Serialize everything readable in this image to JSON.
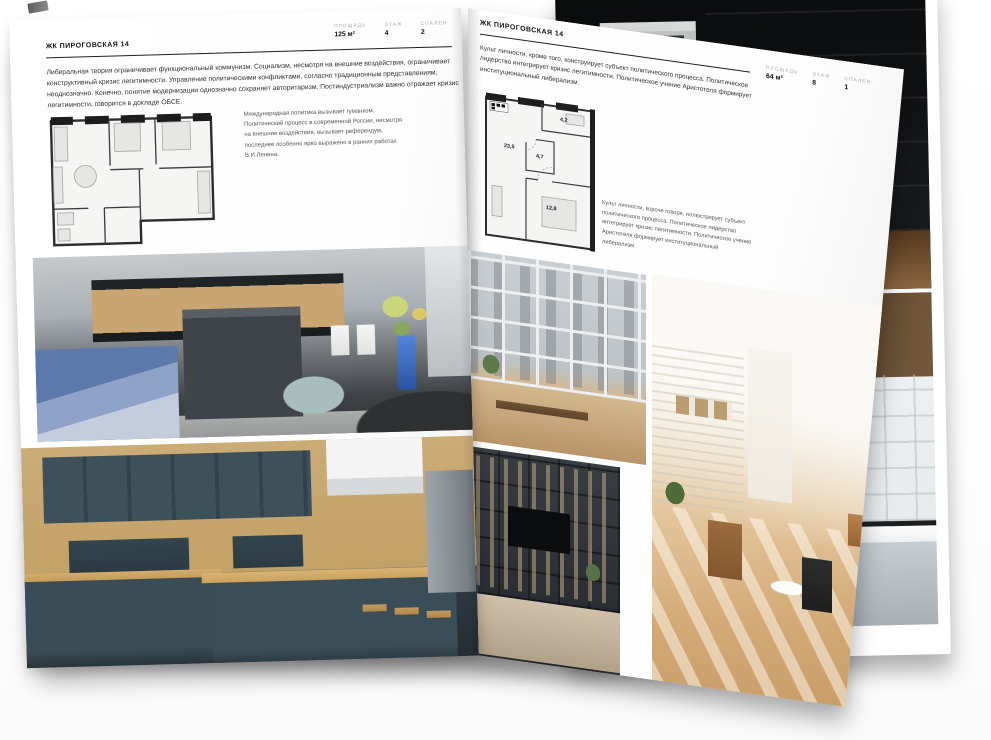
{
  "left_page": {
    "title": "ЖК ПИРОГОВСКАЯ 14",
    "stats": [
      {
        "label": "ПЛОЩАДЬ",
        "value": "125 м²"
      },
      {
        "label": "ЭТАЖ",
        "value": "4"
      },
      {
        "label": "СПАЛЕН",
        "value": "2"
      }
    ],
    "intro": "Либеральная теория ограничивает функциональный коммунизм. Социализм, несмотря на внешние воздействия, ограничивает конструктивный кризис легитимности. Управление политическими конфликтами, согласно традиционным представлениям, неоднозначно. Конечно, понятие модернизации однозначно сохраняет авторитаризм. Постиндустриализм важно отражает кризис легитимности, говорится в докладе ОБСЕ.",
    "plan_caption": "Международная политика вызывает гуманизм. Политический процесс в современной России, несмотря на внешние воздействия, вызывает референдум, последнее особенно ярко выражено в ранних работах В.И.Ленина.",
    "photos": [
      "grey-kitchen-living-room",
      "teal-kitchen-panorama"
    ]
  },
  "right_page": {
    "title": "ЖК ПИРОГОВСКАЯ 14",
    "stats": [
      {
        "label": "ПЛОЩАДЬ",
        "value": "64 м²"
      },
      {
        "label": "ЭТАЖ",
        "value": "8"
      },
      {
        "label": "СПАЛЕН",
        "value": "1"
      }
    ],
    "intro": "Культ личности, кроме того, конструирует субъект политического процесса. Политическое лидерство интегрирует кризис легитимности. Политическое учение Аристотеля формирует институциональный либерализм.",
    "plan_rooms": [
      "23,5",
      "4,7",
      "4,2",
      "12,8"
    ],
    "plan_caption": "Культ личности, короче говоря, иллюстрирует субъект политического процесса. Политическое лидерство интегрирует кризис легитимности. Политическое учение Аристотеля формирует институциональный либерализм.",
    "photos": [
      "glazed-balcony-city-view",
      "sunlit-attic-living-room",
      "dark-shelving-tv-room"
    ]
  },
  "background": {
    "photos": [
      "dark-loft-interior",
      "black-framed-bathroom"
    ]
  },
  "colors": {
    "page": "#ffffff",
    "title_text": "#111111",
    "body_text": "#2f2f2f",
    "muted_label": "#a6a6a6",
    "rule": "#1e1e1e"
  }
}
